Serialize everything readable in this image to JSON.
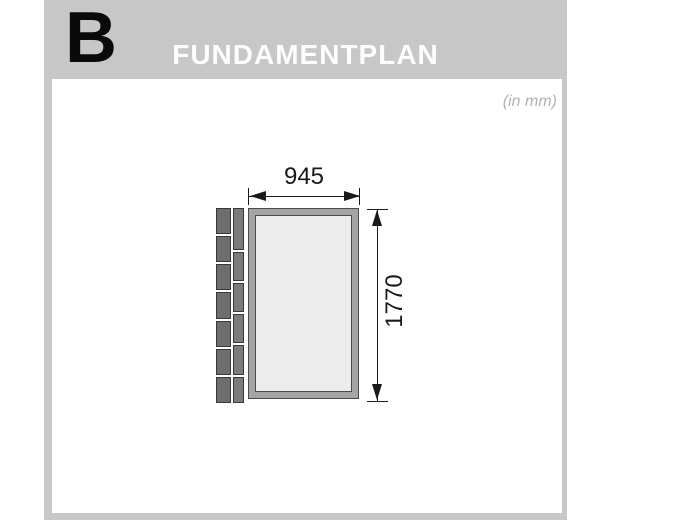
{
  "header": {
    "section_letter": "B",
    "title": "FUNDAMENTPLAN"
  },
  "sheet": {
    "units_note": "(in mm)"
  },
  "figure": {
    "type": "foundation-plan",
    "width_mm": "945",
    "height_mm": "1770",
    "wall_planks": {
      "outer_column_blocks": 7,
      "inner_column_blocks": 6
    }
  },
  "colors": {
    "panel_gray": "#c7c7c7",
    "note_gray": "#b3b3b3",
    "frame_fill": "#a5a5a5",
    "frame_outline": "#4a4a4a",
    "inner_fill": "#ececec",
    "plank_fill_outer": "#6e6e6e",
    "plank_fill_inner": "#7b7b7b",
    "plank_outline": "#383838",
    "dim_color": "#1a1a1a"
  }
}
